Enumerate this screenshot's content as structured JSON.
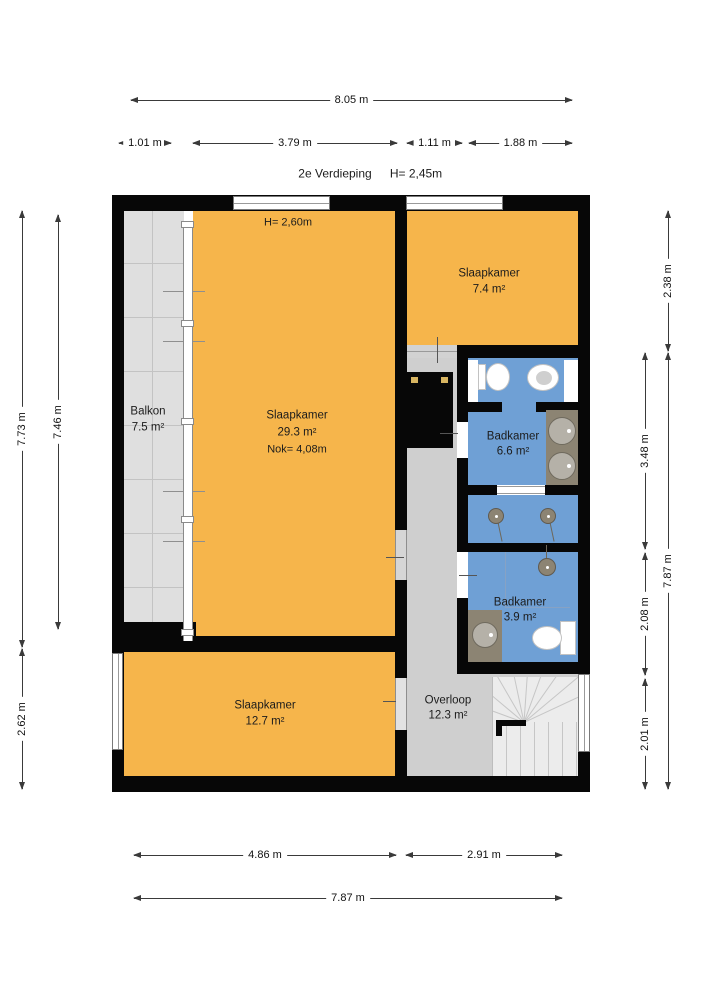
{
  "title": {
    "floor": "2e Verdieping",
    "ceiling_height": "H= 2,45m"
  },
  "dimensions": {
    "top": {
      "total": "8.05 m",
      "segments": [
        "1.01 m",
        "3.79 m",
        "1.11 m",
        "1.88 m"
      ]
    },
    "left": {
      "outer": "7.73 m",
      "inner": "7.46 m",
      "bottom": "2.62 m"
    },
    "right": {
      "top": "2.38 m",
      "outer": "7.87 m",
      "inner": [
        "3.48 m",
        "2.08 m",
        "2.01 m"
      ]
    },
    "bottom": {
      "segments": [
        "4.86 m",
        "2.91 m"
      ],
      "total": "7.87 m"
    }
  },
  "rooms": {
    "balkon": {
      "name": "Balkon",
      "area": "7.5 m²"
    },
    "slaapkamer_hoofd": {
      "name": "Slaapkamer",
      "area": "29.3 m²",
      "ridge": "Nok= 4,08m",
      "ceiling": "H= 2,60m"
    },
    "slaapkamer_klein": {
      "name": "Slaapkamer",
      "area": "7.4 m²"
    },
    "badkamer_groot": {
      "name": "Badkamer",
      "area": "6.6 m²"
    },
    "badkamer_klein": {
      "name": "Badkamer",
      "area": "3.9 m²"
    },
    "slaapkamer_onder": {
      "name": "Slaapkamer",
      "area": "12.7 m²"
    },
    "overloop": {
      "name": "Overloop",
      "area": "12.3 m²"
    }
  },
  "colors": {
    "room_orange": "#F6B54B",
    "bathroom_blue": "#6FA0D5",
    "hall_gray": "#CFCFCF",
    "balcony_gray": "#DFDFDF",
    "wall_black": "#070707",
    "counter_brown": "#8C8473"
  }
}
